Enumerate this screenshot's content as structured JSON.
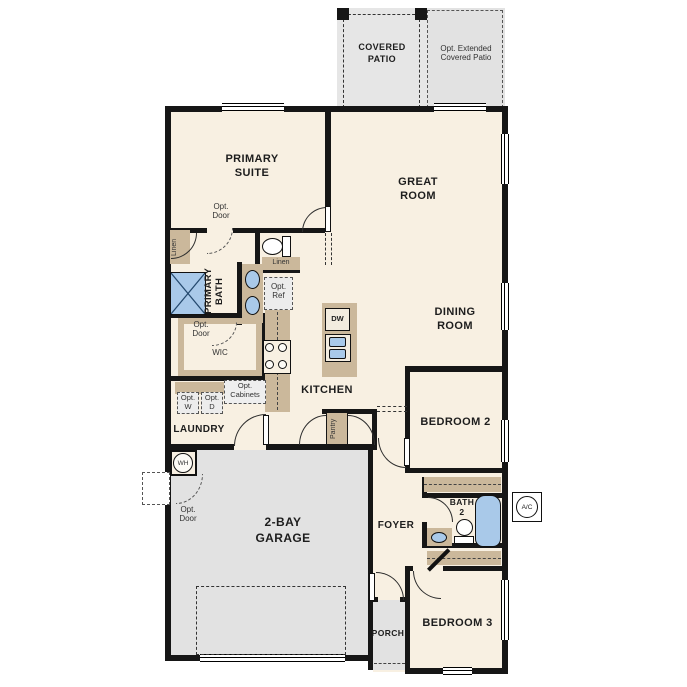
{
  "plan_title": "floor-plan",
  "labels": {
    "covered_patio": "COVERED\nPATIO",
    "extended_patio": "Opt. Extended\nCovered Patio",
    "primary_suite": "PRIMARY\nSUITE",
    "great_room": "GREAT\nROOM",
    "dining_room": "DINING\nROOM",
    "primary_bath": "PRIMARY\nBATH",
    "wic": "WIC",
    "kitchen": "KITCHEN",
    "laundry": "LAUNDRY",
    "garage": "2-BAY\nGARAGE",
    "bedroom2": "BEDROOM 2",
    "bedroom3": "BEDROOM 3",
    "foyer": "FOYER",
    "bath2": "BATH\n2",
    "porch": "PORCH",
    "pantry": "Pantry",
    "linen_left": "Linen",
    "linen_right": "Linen",
    "opt_door_suite": "Opt.\nDoor",
    "opt_door_wic": "Opt.\nDoor",
    "opt_door_garage": "Opt.\nDoor",
    "opt_ref": "Opt.\nRef",
    "opt_w": "Opt.\nW",
    "opt_d": "Opt.\nD",
    "opt_cabinets": "Opt.\nCabinets",
    "dw": "DW",
    "wh": "WH",
    "ac": "A/C"
  },
  "colors": {
    "floor": "#f8f0e2",
    "exterior_concrete": "#e6e6e6",
    "cabinets": "#cbb89b",
    "plumbing_fixtures": "#a9c9e9",
    "walls": "#161616"
  }
}
